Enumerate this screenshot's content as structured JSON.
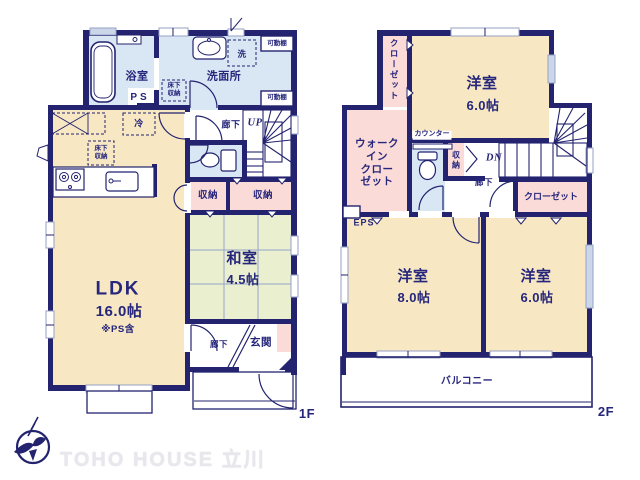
{
  "floor1": {
    "floor_label": "1F",
    "bathroom": "浴室",
    "ps": "PS",
    "washroom": "洗面所",
    "washer": "洗",
    "shelf_top": "可動棚",
    "shelf_bottom": "可動棚",
    "underfloor_washroom": "床下\n収納",
    "underfloor_kitchen": "床下\n収納",
    "fridge": "冷",
    "hallway": "廊下",
    "up": "UP",
    "storage_a": "収納",
    "storage_b": "収納",
    "washitsu": "和室",
    "washitsu_size": "4.5帖",
    "ldk": "LDK",
    "ldk_size": "16.0帖",
    "ldk_note": "※PS含",
    "entry_hall": "廊下",
    "entrance": "玄関"
  },
  "floor2": {
    "floor_label": "2F",
    "closet_top": "クローゼット",
    "bedroom_top": "洋室",
    "bedroom_top_size": "6.0帖",
    "wic": "ウォーク\nイン\nクロー\nゼット",
    "counter": "カウンター",
    "storage": "収\n納",
    "dn": "DN",
    "hallway": "廊下",
    "closet_mid": "クローゼット",
    "eps": "EPS",
    "bedroom_left": "洋室",
    "bedroom_left_size": "8.0帖",
    "bedroom_right": "洋室",
    "bedroom_right_size": "6.0帖",
    "balcony": "バルコニー"
  },
  "logo": {
    "brand": "TOHO HOUSE 立川"
  },
  "colors": {
    "wall": "#23236f",
    "text": "#26267c",
    "room_cream": "#f7e8c3",
    "room_blue": "#d9e7f5",
    "room_pink": "#fadbd7",
    "room_green": "#eaefcf"
  }
}
